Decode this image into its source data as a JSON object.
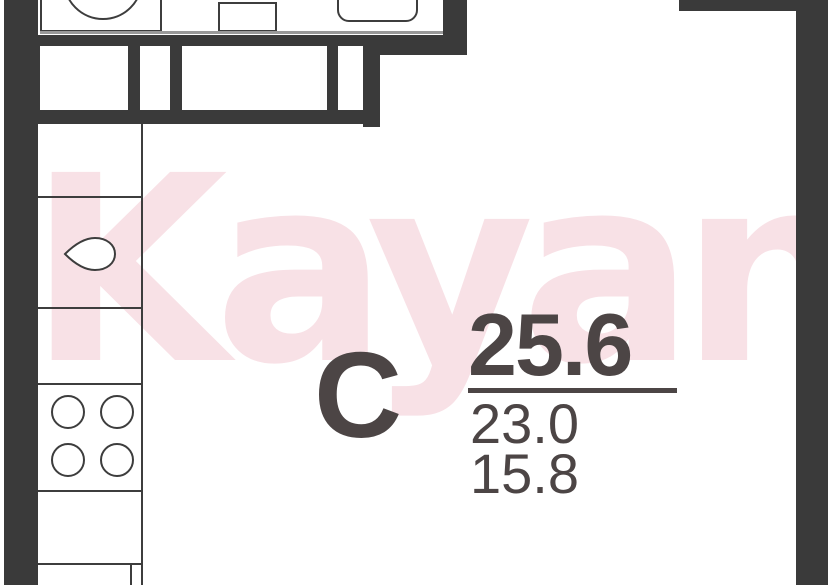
{
  "watermark": {
    "text": "Kayan"
  },
  "unit": {
    "type_label": "С",
    "area_total": "25.6",
    "area_secondary": "23.0",
    "area_tertiary": "15.8"
  },
  "theme": {
    "wall": "#3a3a3a",
    "line": "#3d3d3d",
    "text": "#4c4545",
    "watermark": "#f8e1e6",
    "counter_edge": "#999999",
    "bg": "#ffffff"
  },
  "icons": {
    "washing_machine": "washing-machine-icon",
    "bathroom_sink": "sink-icon",
    "bathtub": "bathtub-icon",
    "kitchen_sink": "teardrop-sink-icon",
    "stove": "stove-burners-icon"
  }
}
